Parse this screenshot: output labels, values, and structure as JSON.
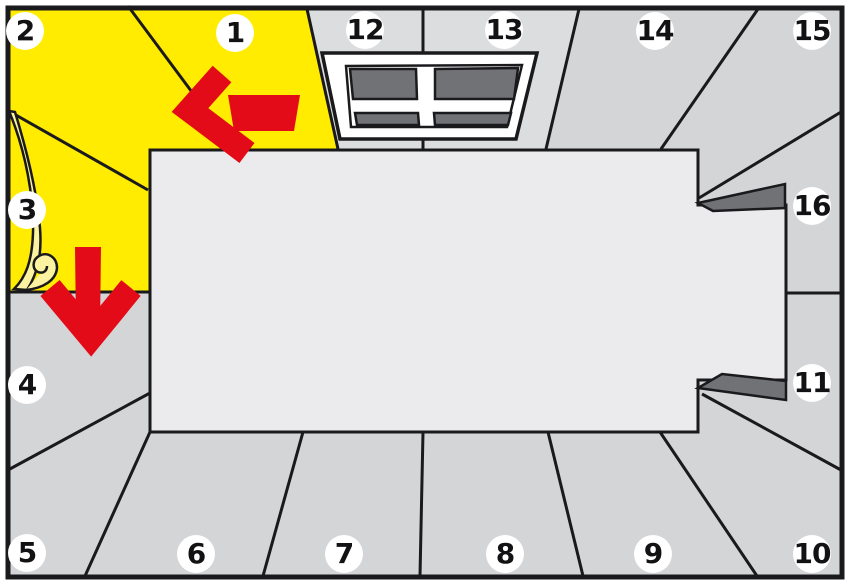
{
  "badges": [
    "1",
    "2",
    "3",
    "4",
    "5",
    "6",
    "7",
    "8",
    "9",
    "10",
    "11",
    "12",
    "13",
    "14",
    "15",
    "16"
  ],
  "icons": {
    "arrow_left": "arrow-left-icon",
    "arrow_down": "arrow-down-icon",
    "window": "window-icon",
    "door_reveal_top": "door-reveal-top",
    "door_reveal_bottom": "door-reveal-bottom",
    "paper_curl": "paper-curl-icon"
  },
  "colors": {
    "highlight_yellow": "#ffec00",
    "curl_pale_yellow": "#fbf3a0",
    "wall_gray": "#d4d5d7",
    "window_wall_gray": "#dcddde",
    "floor_gray": "#ebebed",
    "dark_gray": "#717276",
    "accent_red": "#e30b17",
    "line_black": "#1a1a1d",
    "badge_white": "#ffffff"
  }
}
